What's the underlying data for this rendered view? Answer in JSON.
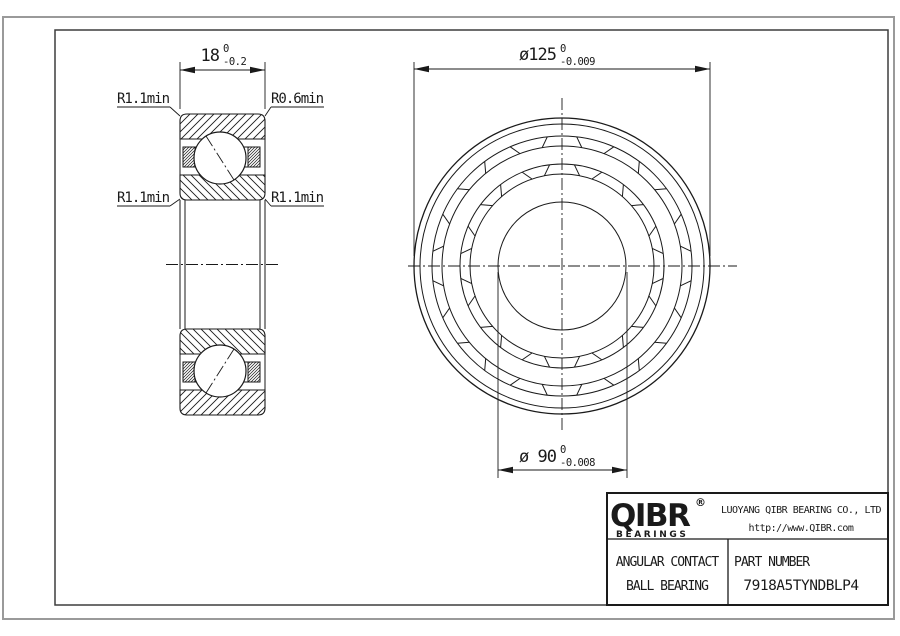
{
  "side_view": {
    "width": {
      "nominal": "18",
      "tol_up": "0",
      "tol_down": "-0.2"
    },
    "radius_labels": {
      "top_left": "R1.1min",
      "top_right": "R0.6min",
      "mid_left": "R1.1min",
      "mid_right": "R1.1min"
    }
  },
  "front_view": {
    "outer_diameter": {
      "nominal": "ø125",
      "tol_up": "0",
      "tol_down": "-0.009"
    },
    "bore_diameter": {
      "nominal": "ø 90",
      "tol_up": "0",
      "tol_down": "-0.008"
    }
  },
  "title_block": {
    "logo_text": "QIBR",
    "logo_registered": "®",
    "logo_subtext": "BEARINGS",
    "company": "LUOYANG QIBR BEARING CO., LTD",
    "website": "http://www.QIBR.com",
    "product_line1": "ANGULAR CONTACT",
    "product_line2": "BALL BEARING",
    "part_number_label": "PART NUMBER",
    "part_number": "7918A5TYNDBLP4"
  },
  "colors": {
    "line": "#1a1a1a",
    "border_outer": "#9a9a9a",
    "border_inner": "#3d3d3d",
    "background": "#ffffff"
  }
}
